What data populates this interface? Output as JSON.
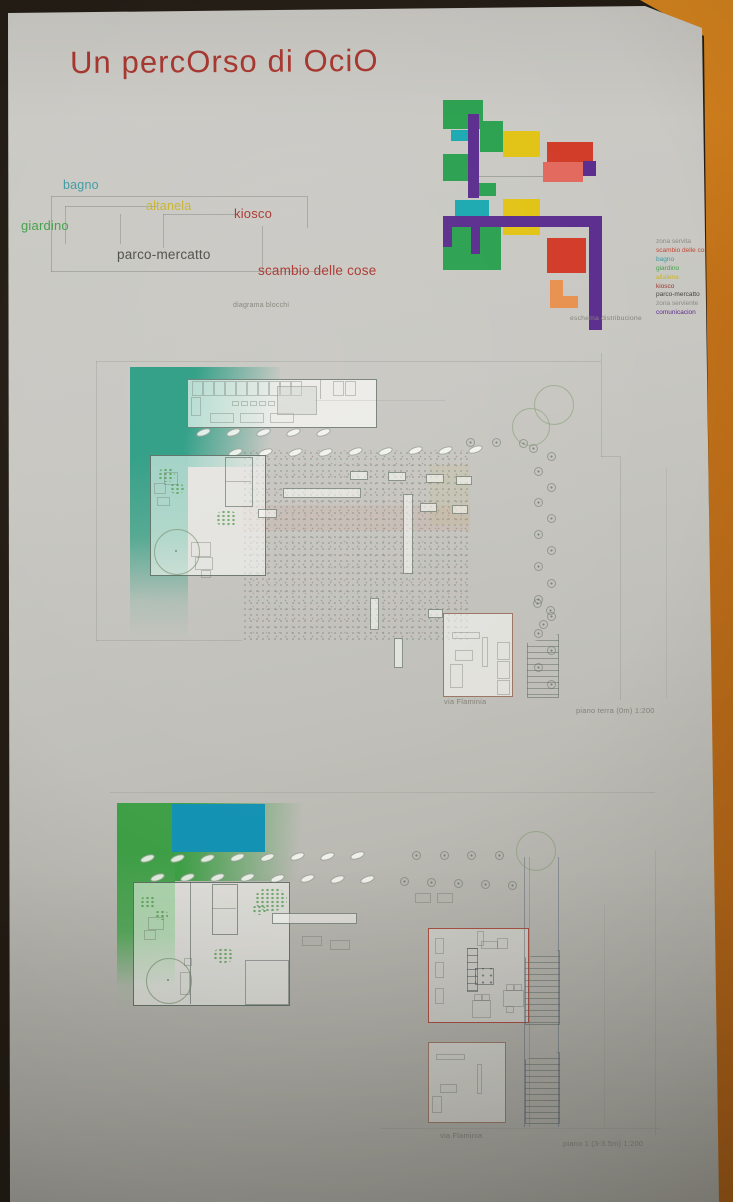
{
  "poster": {
    "title": "Un percOrso di OciO",
    "title_color": "#a9362e",
    "block_diagram": {
      "caption": "diagrama blocchi",
      "labels": [
        {
          "text": "bagno",
          "color": "#3f9ba2"
        },
        {
          "text": "altanela",
          "color": "#c9b42c"
        },
        {
          "text": "kiosco",
          "color": "#a9362e"
        },
        {
          "text": "giardino",
          "color": "#46a04b"
        },
        {
          "text": "parco-mercatto",
          "color": "#4f4f49"
        },
        {
          "text": "scambio delle cose",
          "color": "#a9362e"
        }
      ]
    },
    "schema": {
      "caption": "eschema distribucione",
      "palette": {
        "green": "#2aa14f",
        "teal": "#1ba8b0",
        "yellow": "#e2c315",
        "red": "#d23b28",
        "salmon": "#e2685c",
        "orange": "#e8914e",
        "purple": "#5b2d8e"
      },
      "legend": [
        {
          "text": "zona servita",
          "color": "#8b8a82"
        },
        {
          "text": "scambio delle cose",
          "color": "#bf4a36"
        },
        {
          "text": "bagno",
          "color": "#3f9ba2"
        },
        {
          "text": "giardino",
          "color": "#46a04b"
        },
        {
          "text": "altalena",
          "color": "#c9b42c"
        },
        {
          "text": "kiosco",
          "color": "#9c352c"
        },
        {
          "text": "parco-mercatto",
          "color": "#44443e"
        },
        {
          "text": "zona serviente",
          "color": "#8b8a82"
        },
        {
          "text": "comunicacion",
          "color": "#5b2d8e"
        }
      ]
    },
    "plans": {
      "ground": {
        "street_label": "via Flaminia",
        "caption": "piano terra (0m) 1:200",
        "strip_color": "#2f9e85"
      },
      "first": {
        "street_label": "via Flaminia",
        "caption": "piano 1 (3-3.5m) 1:200",
        "strip_color": "#3fa047",
        "pool_color": "#1492b4"
      }
    }
  }
}
